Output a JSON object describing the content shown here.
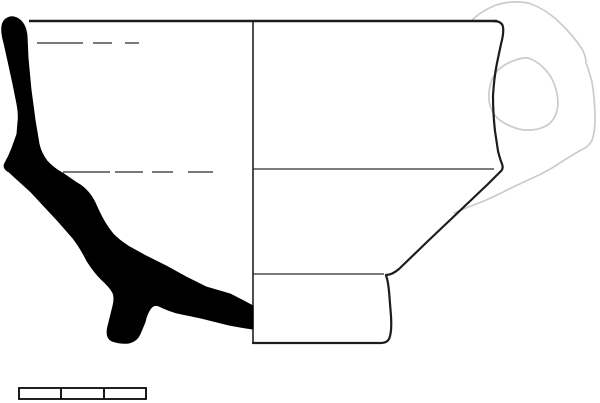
{
  "meta": {
    "description": "Archaeological pottery drawing: cross-section profile (left, solid black) and outline elevation (right) of a carinated cup with a loop handle drawn in light gray; divided scale bar below."
  },
  "colors": {
    "background": "#ffffff",
    "ink": "#000000",
    "outline": "#1c1c1c",
    "thin_line": "#2e2e2e",
    "dashed_line": "#4d4d4d",
    "handle": "#cbcbcb",
    "scale_fill": "#ffffff"
  },
  "drawing": {
    "canvas": {
      "width": 600,
      "height": 403
    },
    "section_path": "M 10 17 Q 3 19 2 26 Q 1 33 4 43 L 8 61 L 13 84 L 17 104 Q 19 114 18 122 L 17 134 L 12 148 Q 9 156 5 163 Q 2 168 9 172 L 20 182 L 31 192 L 44 206 L 58 221 L 72 237 Q 80 247 87 261 Q 94 272 101 279 Q 110 287 113 293 Q 115 298 113 306 L 108 326 Q 105 338 112 341 Q 121 344 129 343 Q 137 341 140 334 L 145 322 Q 147 313 151 308 Q 154 304 159 306 Q 167 310 177 313 L 201 318 L 229 325 Q 245 328 253 329 L 253 306 Q 242 300 230 294 L 206 287 L 186 277 L 166 266 L 146 256 L 128 246 Q 119 240 114 235 Q 105 225 97 207 Q 90 190 77 183 L 64 174 Q 53 168 47 161 Q 41 153 39 144 L 35 120 L 31 90 L 28 58 L 27 36 Q 26 25 20 20 Q 15 16 10 17 Z",
    "wall_outline_path": "M 493 21 Q 502 21 503 27 Q 504 33 501 44 L 497 63 Q 494 78 493 96 Q 493 113 495 131 L 498 151 Q 500 159 502 164 Q 504 169 500 172 Q 495 177 488 184 L 468 203 L 428 241 L 399 269 Q 392 275 386 275 Q 388 281 389 291 L 391 316 Q 392 333 389 339 Q 387 343 380 343 L 253 343",
    "rim_line_path": "M 29 21 L 497 21",
    "centerline_path": "M 253 21 L 253 343",
    "carination_line_path": "M 253 169 L 494 169",
    "foot_top_line_path": "M 253 274 L 384 274",
    "dashed_upper_path": "M 37 43 L 83 43 M 93 43 L 112 43 M 125 43 L 139 43",
    "dashed_lower_path": "M 63 172 L 110 172 M 115 172 L 143 172 M 152 172 L 173 172 M 188 172 L 213 172",
    "handle": {
      "outer_path": "M 471 21 Q 481 11 496 5 Q 512 0 528 3 Q 544 8 558 21 Q 573 35 582 49 Q 586 56 586 63 Q 589 71 592 82 Q 595 100 595 118 Q 595 130 593 137 Q 591 146 581 150 L 566 159 L 552 168 L 539 175 L 526 181 L 509 189 Q 494 197 479 203 Q 463 209 454 213",
      "inner_path": "M 523 58 Q 508 61 498 70 Q 490 79 489 93 Q 488 103 492 110 Q 494 116 501 121 Q 511 128 524 130 Q 539 131 549 124 Q 557 117 558 104 Q 558 90 551 77 Q 543 65 533 60 Q 527 57 523 58 Z"
    }
  },
  "scale_bar": {
    "segments": 3,
    "frame_path": "M 19 388 L 146 388 L 146 399 L 19 399 Z",
    "divisions_path": "M 61 388 L 61 399 M 104 388 L 104 399"
  }
}
